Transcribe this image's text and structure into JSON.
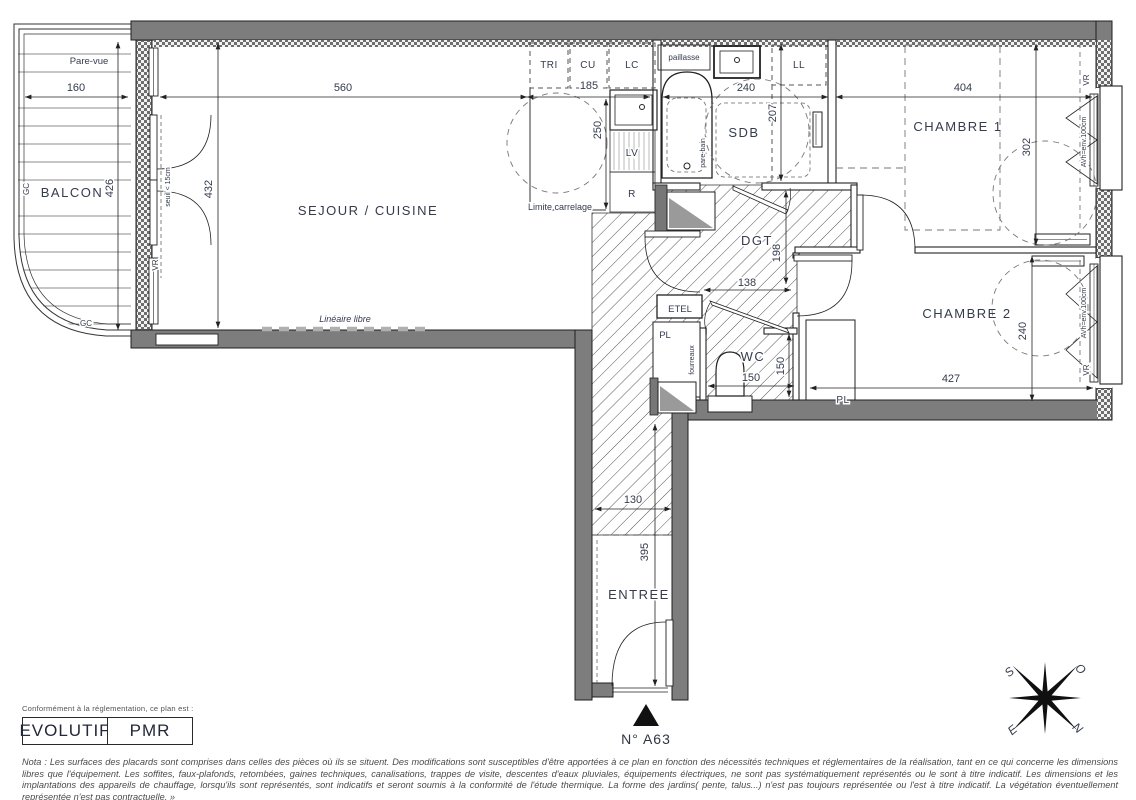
{
  "rooms": {
    "balcon": "BALCON",
    "sejour_cuisine": "SEJOUR / CUISINE",
    "chambre1": "CHAMBRE 1",
    "chambre2": "CHAMBRE 2",
    "sdb": "SDB",
    "dgt": "DGT",
    "wc": "WC",
    "entree": "ENTREE",
    "etel": "ETEL",
    "pl_hall": "PL",
    "pl_chambre2": "PL",
    "ll": "LL",
    "lv": "LV",
    "refrigerateur": "R",
    "tri": "TRI",
    "cu": "CU",
    "lc": "LC",
    "paillasse": "paillasse"
  },
  "dims": {
    "balcon_largeur": "160",
    "balcon_profondeur": "426",
    "sejour_largeur": "560",
    "sejour_profondeur": "432",
    "cuisine_largeur": "185",
    "cuisine_profondeur": "250",
    "sdb_largeur": "240",
    "sdb_profondeur": "207",
    "chambre1_largeur": "404",
    "chambre1_profondeur": "302",
    "dgt_profondeur": "198",
    "dgt_largeur": "138",
    "wc_largeur": "150",
    "wc_profondeur": "150",
    "entree_largeur": "130",
    "entree_profondeur": "395",
    "chambre2_largeur": "427",
    "chambre2_profondeur": "240"
  },
  "annotations": {
    "pare_vue": "Pare-vue",
    "gc_vertical": "GC",
    "gc_bas": "GC",
    "seuil": "seuil < 15cm",
    "vr_sejour": "VR",
    "limite_carrelage": "Limite carrelage",
    "lineaire_libre": "Linéaire libre",
    "pare_bain": "pare-bain",
    "fourreaux": "fourreaux",
    "vr_chambre1": "VR",
    "avh_chambre1": "AVh=env.100cm",
    "vr_chambre2": "VR",
    "avh_chambre2": "AVh=env.100cm"
  },
  "lot": {
    "numero": "N° A63"
  },
  "compass": {
    "nord": "N",
    "sud": "S",
    "est": "E",
    "ouest": "O"
  },
  "legend": {
    "intro": "Conformément à la réglementation, ce plan est :",
    "badge1": "EVOLUTIF",
    "badge2": "PMR"
  },
  "nota": {
    "text": "Nota : Les surfaces des placards sont comprises dans celles des pièces où ils se situent. Des modifications sont susceptibles d'être apportées à ce plan en fonction des nécessités techniques et réglementaires de la réalisation, tant en ce qui concerne les dimensions libres que l'équipement.  Les soffites, faux-plafonds, retombées, gaines techniques, canalisations, trappes de visite, descentes d'eaux pluviales, équipements électriques, ne sont pas systématiquement représentés ou le sont à titre indicatif. Les dimensions et les implantations des appareils de chauffage, lorsqu'ils sont représentés, sont indicatifs et seront soumis à la conformité de l'étude thermique. La forme des jardins( pente, talus...) n'est pas toujours représentée ou l'est à titre indicatif. La végétation éventuellement représentée n'est pas contractuelle. »"
  },
  "colors": {
    "wall": "#7d7d7d",
    "line": "#222222",
    "label": "#343b4d",
    "hatch": "#555555"
  }
}
